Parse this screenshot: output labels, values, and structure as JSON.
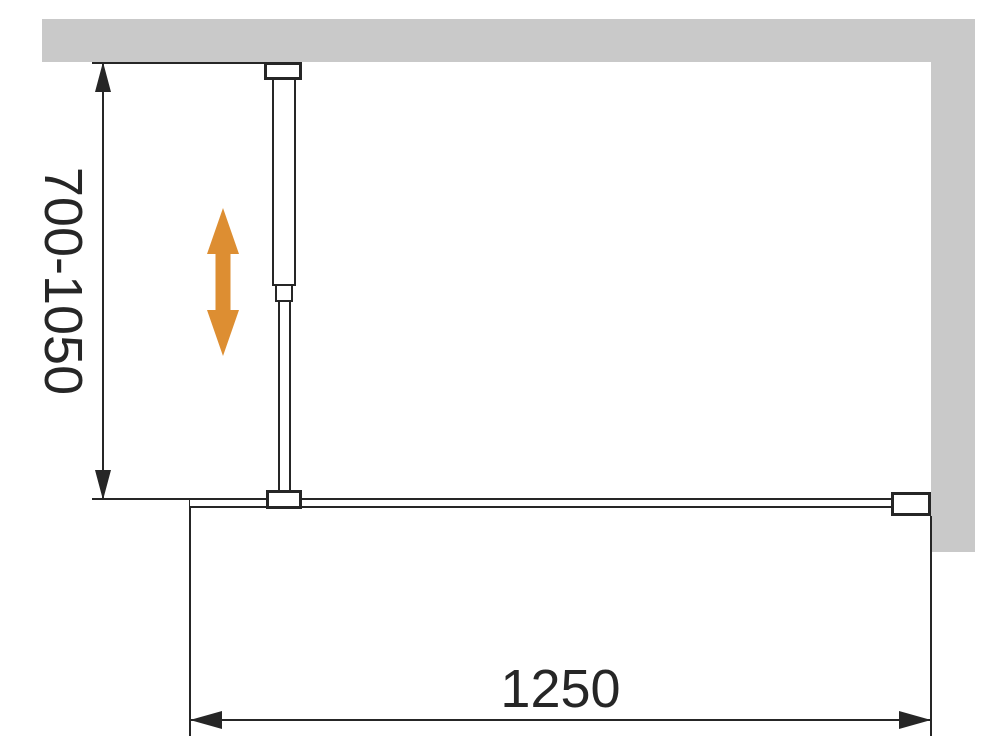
{
  "labels": {
    "height_range": "700-1050",
    "width": "1250"
  },
  "colors": {
    "bg": "#ffffff",
    "wall": "#c9c9c9",
    "line": "#262626",
    "accent": "#dd8e32"
  },
  "icons": {
    "adjust_arrow": "double-headed-vertical-arrow"
  }
}
